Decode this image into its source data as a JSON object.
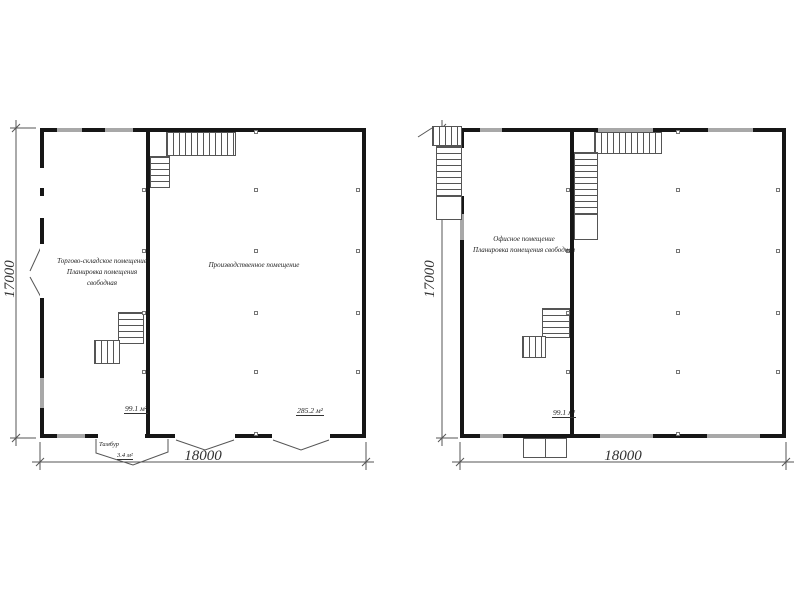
{
  "page": {
    "background": "#ffffff",
    "wall_color": "#161616",
    "window_color": "#a8a8a8",
    "line_color": "#555555"
  },
  "plans": [
    {
      "id": "first-floor-plan",
      "rooms": [
        {
          "label_line1": "Торгово-складское помещение",
          "label_line2": "Планировка помещения свободная",
          "area": "99.1 м²"
        },
        {
          "label_line1": "Производственное помещение",
          "label_line2": "",
          "area": "285.2 м²"
        }
      ],
      "vestibule": {
        "label": "Тамбур",
        "area": "3.4 м²"
      },
      "dim_width": "18000",
      "dim_height": "17000"
    },
    {
      "id": "second-floor-plan",
      "rooms": [
        {
          "label_line1": "Офисное помещение",
          "label_line2": "Планировка помещения свободная",
          "area": "99.1 м²"
        }
      ],
      "dim_width": "18000",
      "dim_height": "17000"
    }
  ]
}
